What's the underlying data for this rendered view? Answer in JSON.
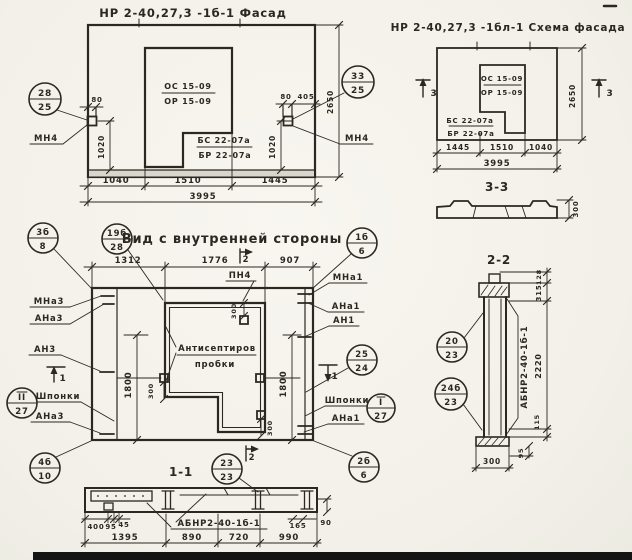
{
  "colors": {
    "ink": "#2b2721",
    "paper": "#f5f3ec",
    "plinth": "#d9d6ce",
    "scan_band": "#141414"
  },
  "facade": {
    "title": "НР 2-40,27,3 -1б-1 Фасад",
    "win_top": "ОС 15-09",
    "win_bot": "ОР 15-09",
    "blk_top": "БС 22-07а",
    "blk_bot": "БР 22-07а",
    "mn4": "МН4",
    "d80": "80",
    "d405": "405",
    "d1020": "1020",
    "d2650": "2650",
    "b1": "1040",
    "b2": "1510",
    "b3": "1445",
    "total": "3995"
  },
  "schema": {
    "title": "НР 2-40,27,3 -1бл-1 Схема фасада",
    "win_top": "ОС 15-09",
    "win_bot": "ОР 15-09",
    "blk_top": "БС 22-07а",
    "blk_bot": "БР 22-07а",
    "mark3": "3",
    "d2650": "2650",
    "b1": "1445",
    "b2": "1510",
    "b3": "1040",
    "total": "3995",
    "sec_title": "3-3",
    "sec_h": "300"
  },
  "inner": {
    "title": "Вид с внутренней стороны",
    "note1": "Антисептиров",
    "note2": "пробки",
    "pn4": "ПН4",
    "l_mna3": "МНа3",
    "l_ana3": "АНа3",
    "l_an3": "АН3",
    "l_shponki": "Шпонки",
    "l_ana3b": "АНа3",
    "r_mna1": "МНа1",
    "r_ana1": "АНа1",
    "r_an1": "АН1",
    "r_shponki": "Шпонки",
    "r_ana1b": "АНа1",
    "d1312": "1312",
    "d1776": "1776",
    "d907": "907",
    "d1800": "1800",
    "d300": "300",
    "mark1": "1",
    "mark2": "2"
  },
  "s11": {
    "title": "1-1",
    "label": "АБНР2-40-1б-1",
    "d400": "400",
    "d95": "95",
    "d45": "45",
    "d165": "165",
    "d90": "90",
    "b1": "1395",
    "b2": "890",
    "b3": "720",
    "b4": "990"
  },
  "s22": {
    "title": "2-2",
    "label": "АБНР2-40-1б-1",
    "d128": "128",
    "d315": "315",
    "d2220": "2220",
    "d115": "115",
    "d95": "95",
    "d300": "300"
  },
  "markers": {
    "m28_25": {
      "num": "28",
      "den": "25"
    },
    "m33_25": {
      "num": "33",
      "den": "25"
    },
    "m3b_8": {
      "num": "3б",
      "den": "8"
    },
    "m19b_28": {
      "num": "19б",
      "den": "28"
    },
    "m1b_6": {
      "num": "1б",
      "den": "6"
    },
    "mII_27": {
      "num": "II",
      "den": "27"
    },
    "m4b_10": {
      "num": "4б",
      "den": "10"
    },
    "m25_24": {
      "num": "25",
      "den": "24"
    },
    "mI_27": {
      "num": "I",
      "den": "27"
    },
    "m23a_23": {
      "num": "23а",
      "den": "23"
    },
    "m23_23": {
      "num": "23",
      "den": "23"
    },
    "m2b_6": {
      "num": "2б",
      "den": "6"
    },
    "m20_23": {
      "num": "20",
      "den": "23"
    },
    "m24b_23": {
      "num": "24б",
      "den": "23"
    }
  }
}
